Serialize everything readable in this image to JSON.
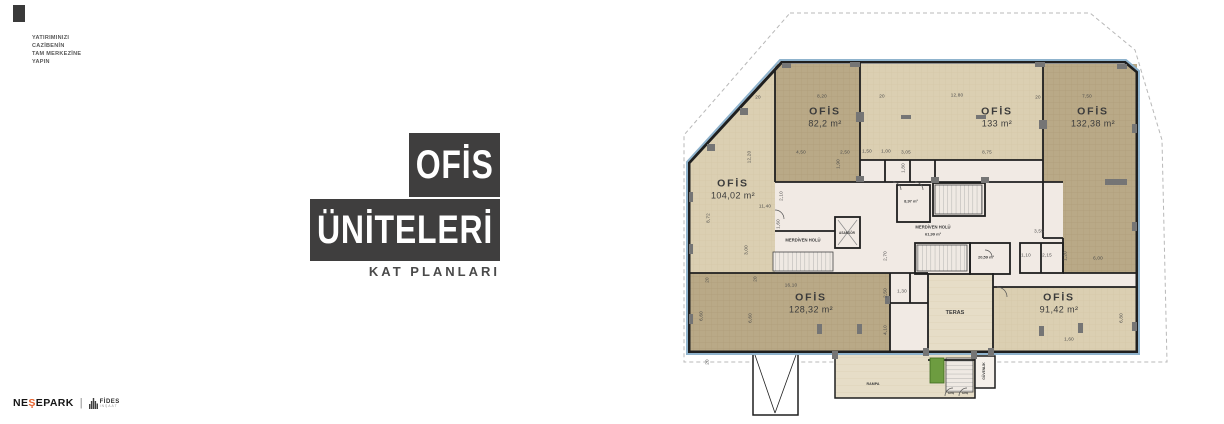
{
  "branding": {
    "tagline": [
      "YATIRIMINIZI",
      "CAZİBENİN",
      "TAM MERKEZİNE",
      "YAPIN"
    ],
    "title_top": "OFİS",
    "title_bottom": "ÜNİTELERİ",
    "subtitle": "KAT PLANLARI",
    "footer": {
      "brand_pre": "NE",
      "brand_accent": "Ş",
      "brand_post": "EPARK",
      "divider": "|",
      "partner_name": "FİDES",
      "partner_sub": "İNŞAAT"
    }
  },
  "colors": {
    "title_box": "#3f3e3e",
    "accent_orange": "#e8622d",
    "plan_boundary_blue": "#8fb3cd",
    "office_dark_tan": "#b9a987",
    "office_light_tan": "#dbcfb2",
    "walkway_tan": "#e6ddc7",
    "core_pink": "#f1eae4",
    "wall": "#1f1f1f",
    "column_gray": "#757575",
    "planter_green": "#6d9c40"
  },
  "plan": {
    "rooms": [
      {
        "label": "OFİS",
        "area": "82,2 m²",
        "x": 180,
        "y": 117
      },
      {
        "label": "OFİS",
        "area": "133 m²",
        "x": 352,
        "y": 117
      },
      {
        "label": "OFİS",
        "area": "132,38 m²",
        "x": 448,
        "y": 117
      },
      {
        "label": "OFİS",
        "area": "104,02 m²",
        "x": 88,
        "y": 189
      },
      {
        "label": "OFİS",
        "area": "128,32 m²",
        "x": 166,
        "y": 303
      },
      {
        "label": "OFİS",
        "area": "91,42 m²",
        "x": 414,
        "y": 303
      }
    ],
    "core_labels": [
      {
        "t": "MERDİVEN HOLÜ",
        "x": 158,
        "y": 240,
        "s": 4.2
      },
      {
        "t": "ASANSÖR",
        "x": 202,
        "y": 233,
        "s": 3.2
      },
      {
        "t": "MERDİVEN HOLÜ",
        "x": 288,
        "y": 227,
        "s": 4.2
      },
      {
        "t": "61,99 m²",
        "x": 288,
        "y": 234,
        "s": 4
      },
      {
        "t": "8,97 m²",
        "x": 266,
        "y": 201,
        "s": 4
      },
      {
        "t": "20,59 m²",
        "x": 341,
        "y": 257,
        "s": 4
      },
      {
        "t": "TERAS",
        "x": 310,
        "y": 313,
        "s": 5.5
      },
      {
        "t": "RAMPA",
        "x": 228,
        "y": 384,
        "s": 3.6
      },
      {
        "t": "GÜVENLİK",
        "x": 339,
        "y": 371,
        "s": 3.4,
        "r": -90
      },
      {
        "t": "Giriş",
        "x": 306,
        "y": 393,
        "s": 2.8
      },
      {
        "t": "Giriş",
        "x": 320,
        "y": 393,
        "s": 2.8
      }
    ],
    "dims": [
      {
        "t": "20",
        "x": 113,
        "y": 97
      },
      {
        "t": "8,20",
        "x": 177,
        "y": 96
      },
      {
        "t": "20",
        "x": 237,
        "y": 96
      },
      {
        "t": "12,80",
        "x": 312,
        "y": 95
      },
      {
        "t": "20",
        "x": 393,
        "y": 97
      },
      {
        "t": "7,50",
        "x": 442,
        "y": 96
      },
      {
        "t": "4,50",
        "x": 156,
        "y": 152
      },
      {
        "t": "2,50",
        "x": 200,
        "y": 152
      },
      {
        "t": "1,50",
        "x": 222,
        "y": 151
      },
      {
        "t": "1,00",
        "x": 241,
        "y": 151
      },
      {
        "t": "3,05",
        "x": 261,
        "y": 152
      },
      {
        "t": "8,75",
        "x": 342,
        "y": 152
      },
      {
        "t": "12,20",
        "x": 104,
        "y": 157,
        "r": -90
      },
      {
        "t": "8,72",
        "x": 63,
        "y": 218,
        "r": -90
      },
      {
        "t": "11,40",
        "x": 120,
        "y": 206
      },
      {
        "t": "2,10",
        "x": 136,
        "y": 196,
        "r": -90
      },
      {
        "t": "1,90",
        "x": 193,
        "y": 164,
        "r": -90
      },
      {
        "t": "1,80",
        "x": 258,
        "y": 168,
        "r": -90
      },
      {
        "t": "1,60",
        "x": 133,
        "y": 224,
        "r": -90
      },
      {
        "t": "3,00",
        "x": 101,
        "y": 250,
        "r": -90
      },
      {
        "t": "16,10",
        "x": 146,
        "y": 285
      },
      {
        "t": "2,70",
        "x": 240,
        "y": 256,
        "r": -90
      },
      {
        "t": "2,50",
        "x": 240,
        "y": 293,
        "r": -90
      },
      {
        "t": "1,30",
        "x": 257,
        "y": 291
      },
      {
        "t": "4,10",
        "x": 240,
        "y": 330,
        "r": -90
      },
      {
        "t": "3,55",
        "x": 394,
        "y": 231
      },
      {
        "t": "1,10",
        "x": 381,
        "y": 255
      },
      {
        "t": "2,15",
        "x": 402,
        "y": 255
      },
      {
        "t": "1,20",
        "x": 420,
        "y": 256,
        "r": -90
      },
      {
        "t": "6,00",
        "x": 453,
        "y": 258
      },
      {
        "t": "6,80",
        "x": 476,
        "y": 318,
        "r": -90
      },
      {
        "t": "1,60",
        "x": 424,
        "y": 339
      },
      {
        "t": "6,60",
        "x": 56,
        "y": 316,
        "r": -90
      },
      {
        "t": "6,60",
        "x": 105,
        "y": 318,
        "r": -90
      },
      {
        "t": "20",
        "x": 62,
        "y": 280,
        "r": -90
      },
      {
        "t": "20",
        "x": 110,
        "y": 279,
        "r": -90
      },
      {
        "t": "20",
        "x": 62,
        "y": 362,
        "r": -90
      }
    ]
  }
}
